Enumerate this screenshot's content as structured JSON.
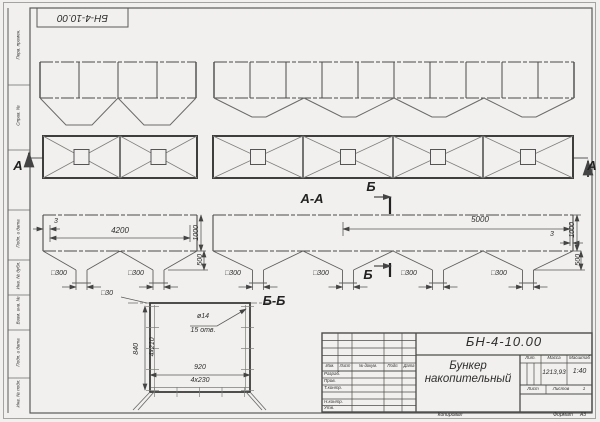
{
  "doc": {
    "number": "БН-4-10.00",
    "name_line1": "Бункер",
    "name_line2": "накопительный",
    "mass_value": "1213,93",
    "scale_value": "1:40",
    "sheets_value": "1"
  },
  "title_block": {
    "lit_label": "Лит.",
    "mass_label": "Масса",
    "scale_label": "Масштаб",
    "sheet_label": "Лист",
    "sheets_label": "Листов",
    "copied_label": "Копировал",
    "format_label": "Формат",
    "format_value": "А3",
    "header_cols": [
      "Изм.",
      "Лист",
      "№ докум.",
      "Подп.",
      "Дата"
    ],
    "row_labels": [
      "Разраб.",
      "Пров.",
      "Т.контр.",
      "Н.контр.",
      "Утв."
    ]
  },
  "margin_labels": [
    "Перв. примен.",
    "Справ. №",
    "Подп. и дата",
    "Инв. № дубл.",
    "Взам. инв. №",
    "Подп. и дата",
    "Инв. № подл."
  ],
  "sections": {
    "front_cut": "А-А",
    "detail_cut": "Б-Б",
    "mark_a": "А",
    "mark_b": "Б"
  },
  "dimensions": {
    "wall_thickness": "3",
    "left_length": "4200",
    "right_length": "5000",
    "body_height": "1000",
    "hopper_height": "500",
    "outlet_size": "□300",
    "tube_size": "□30",
    "hole_diameter": "ø14",
    "hole_count": "15 отв.",
    "flange_height": "840",
    "hole_spacing_v": "4x210",
    "flange_width": "920",
    "hole_spacing_h": "4x230"
  }
}
